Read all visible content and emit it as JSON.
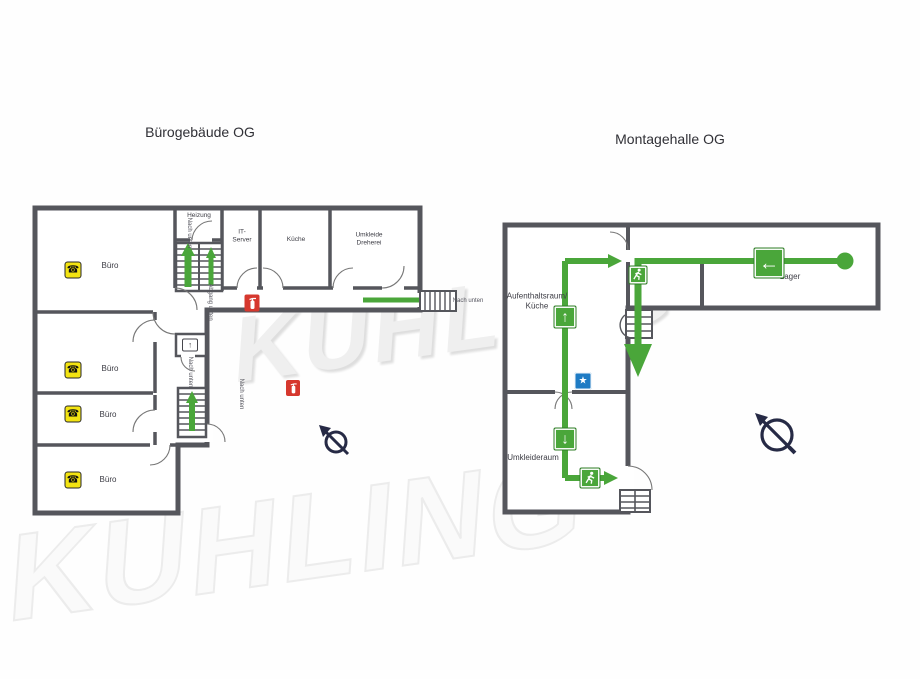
{
  "document": {
    "watermark": "KÜHLING"
  },
  "left_plan": {
    "title": "Bürogebäude OG",
    "rooms": {
      "buero1": "Büro",
      "buero2": "Büro",
      "buero3": "Büro",
      "buero4": "Büro",
      "heizung": "Heizung",
      "it_server": "IT-\nServer",
      "kueche": "Küche",
      "umkleide_dreherei": "Umkleide\nDreherei"
    },
    "notes": {
      "stair_top": "Nach unten",
      "abgang": "Abgang unten",
      "mid_stair": "Nach unten",
      "wing_stair": "Nach unten",
      "east_exit": "Nach unten"
    }
  },
  "right_plan": {
    "title": "Montagehalle OG",
    "rooms": {
      "aufenthaltsraum": "Aufenthaltsraum/\nKüche",
      "lager": "Lager",
      "umkleideraum": "Umkleideraum"
    }
  },
  "icons": {
    "phone_glyph": "☎",
    "star_glyph": "★",
    "arrow_left_glyph": "←",
    "arrow_up_glyph": "↑",
    "arrow_down_glyph": "↓",
    "wc_arrow_glyph": "↑"
  },
  "colors": {
    "route_green": "#4aa63a",
    "wall_gray": "#55565c",
    "phone_yellow": "#f3e412",
    "extinguisher_red": "#d6382e",
    "info_blue": "#1e7bc4"
  }
}
